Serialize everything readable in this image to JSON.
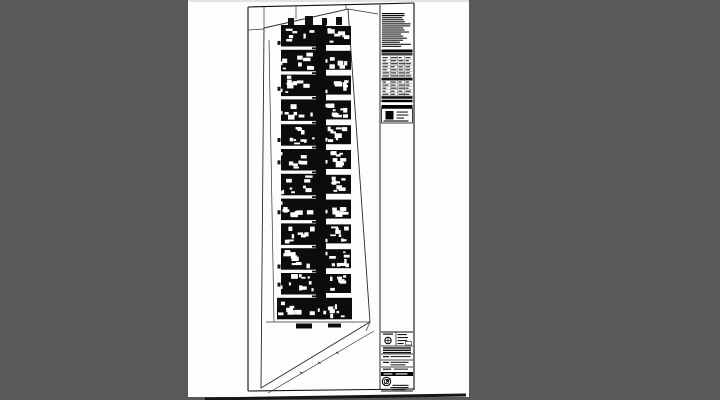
{
  "viewer": {
    "background_color": "#59595b",
    "page_color": "#fdfdfd",
    "page_top_highlight": "#e2e2e2"
  },
  "drawing": {
    "ink": "#101010",
    "faint": "#555555",
    "scan_bar_color": "#161616",
    "sheet_border": {
      "top": [
        248,
        7,
        414,
        3
      ],
      "left": [
        248,
        7,
        248,
        391
      ],
      "right": [
        414,
        3,
        414,
        390
      ],
      "bottom": [
        248,
        391,
        414,
        389
      ],
      "notes_divider": [
        380,
        5,
        380,
        390
      ]
    },
    "site": {
      "boundary": [
        [
          264,
          28
        ],
        [
          348,
          9
        ],
        [
          370,
          322
        ],
        [
          261,
          388
        ]
      ],
      "extra_lines": [
        [
          348,
          9,
          378,
          14
        ],
        [
          268,
          393,
          374,
          331
        ],
        [
          264,
          7,
          264,
          28
        ],
        [
          296,
          6,
          296,
          19
        ],
        [
          346,
          5,
          346,
          9
        ],
        [
          266,
          322,
          370,
          322
        ],
        [
          370,
          322,
          366,
          331
        ],
        [
          248,
          30,
          264,
          29
        ],
        [
          269,
          40,
          274,
          322
        ]
      ],
      "diagonal_ticks": [
        [
          300,
          372
        ],
        [
          318,
          362
        ],
        [
          336,
          352
        ]
      ]
    },
    "floors": {
      "count": 12,
      "top": 25,
      "pitch": 24.8,
      "block_h": 21.5,
      "left_x": 281,
      "left_w": 35,
      "corridor_x": 316,
      "corridor_w": 10,
      "right_x": 326,
      "right_w": 25,
      "ground_x": 277,
      "ground_w": 75,
      "roof_ticks": [
        [
          288,
          18,
          6,
          7
        ],
        [
          305,
          16,
          8,
          9
        ],
        [
          322,
          18,
          5,
          7
        ],
        [
          336,
          17,
          6,
          8
        ]
      ],
      "entry_marks": [
        [
          296,
          323.5,
          16,
          5
        ],
        [
          328,
          323.5,
          13,
          4
        ]
      ],
      "label_x": 312,
      "label_w": 7,
      "label_h": 1.8
    },
    "notes_col": {
      "x": 382,
      "w": 30,
      "text_block": {
        "y": 13,
        "lines": 17,
        "lh": 2.05
      },
      "header_bar": {
        "y": 49.5,
        "h": 3
      },
      "subheader": {
        "y": 53,
        "h": 2.5
      },
      "table": {
        "y": 56.5,
        "rows": 14,
        "row_h": 3.05,
        "col_x": [
          382.5,
          391,
          398.5,
          405.5
        ],
        "divider_x": [
          390.5,
          397.5,
          404.5
        ],
        "dark_rows": [
          7,
          13
        ]
      },
      "footer_bars": [
        [
          381.5,
          99.8,
          31,
          2.4
        ],
        [
          381.5,
          105,
          31,
          3
        ]
      ],
      "key_box": {
        "x": 381.5,
        "y": 108.5,
        "w": 31,
        "h": 14.5,
        "square": [
          385.5,
          111,
          8,
          8.5
        ]
      }
    },
    "title_block": {
      "x": 381.5,
      "w": 31,
      "top_y": 332,
      "bottom_y": 391,
      "divider_ys": [
        346,
        354,
        360,
        367
      ],
      "vdiv": [
        396,
        332,
        396,
        346
      ],
      "bar": {
        "y": 372,
        "h": 4
      },
      "stamp1": {
        "cx": 388,
        "cy": 340.5,
        "r": 3.2
      },
      "stamp2": {
        "cx": 386.5,
        "cy": 381.5,
        "r": 4.2
      }
    },
    "scan_bar": [
      205,
      397.5,
      466,
      393.5
    ]
  }
}
